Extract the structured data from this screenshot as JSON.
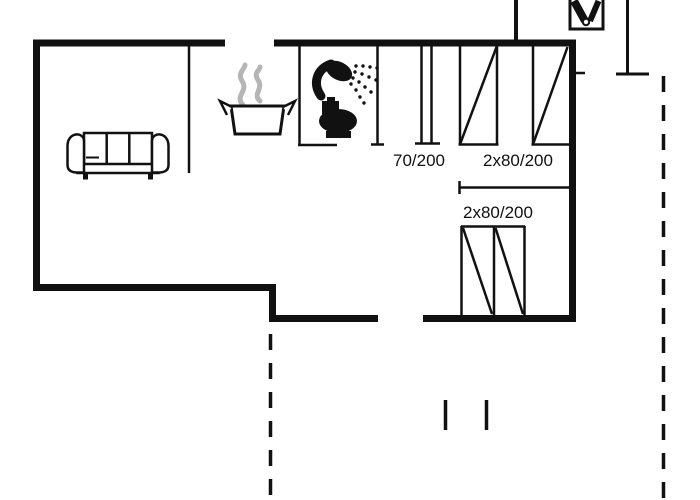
{
  "floor_plan": {
    "background_color": "#ffffff",
    "wall_color": "#111111",
    "steam_color": "#b5b5b5",
    "labels": {
      "door_opening": "70/200",
      "upper_window": "2x80/200",
      "lower_window": "2x80/200"
    },
    "icons": {
      "sofa": "sofa-icon",
      "cooking_pot": "cooking-pot-icon",
      "shower": "shower-icon",
      "toilet": "toilet-icon",
      "grill": "grill-icon"
    }
  }
}
